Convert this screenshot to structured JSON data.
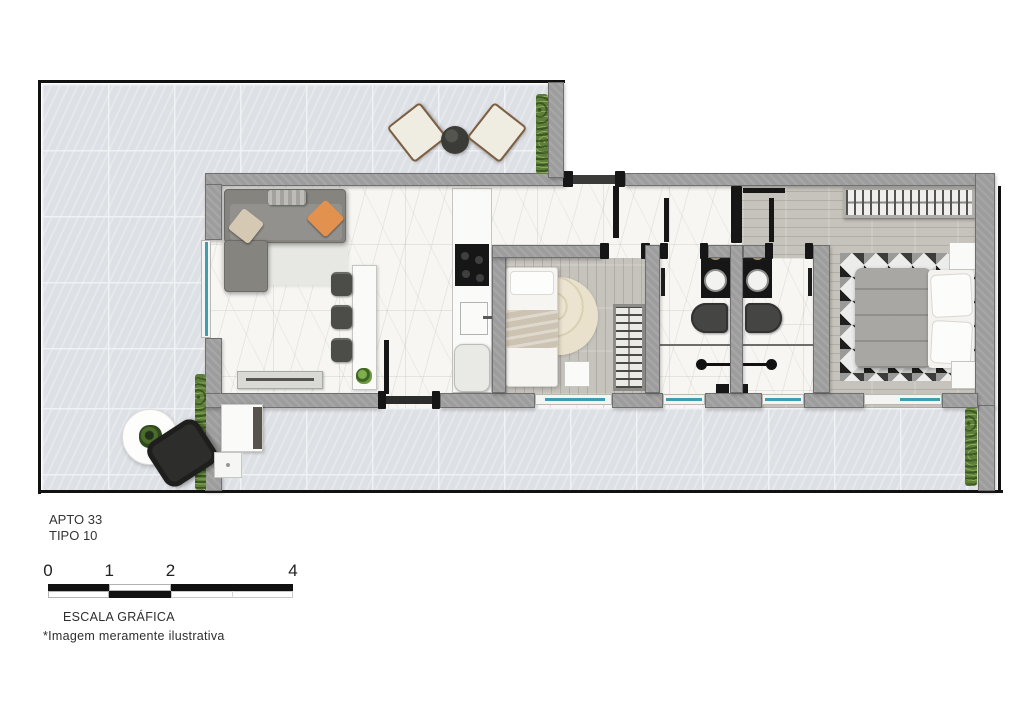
{
  "header": {
    "apartment": "APTO 33",
    "type": "TIPO 10"
  },
  "scale_bar": {
    "ticks": [
      "0",
      "1",
      "2",
      "4"
    ],
    "caption": "ESCALA GRÁFICA"
  },
  "footnote": "*Imagem meramente ilustrativa",
  "colors": {
    "boundary": "#111111",
    "wall": "#9d9d9d",
    "wall_edge": "#6f6f6f",
    "terrace_tile": "#dde0e5",
    "tile_grout": "#f0f2f4",
    "marble": "#f7f6f3",
    "wood": "#c6c2bc",
    "hedge": "#5d7f39",
    "glass": "#3e9db0",
    "fixture_black": "#161616",
    "accent_orange": "#e2914e",
    "cushion_beige": "#d6c9b4",
    "duvet_gray": "#a8a7a4",
    "blanket_beige": "#cdc3b2",
    "rug_cream": "#ece4d0"
  }
}
